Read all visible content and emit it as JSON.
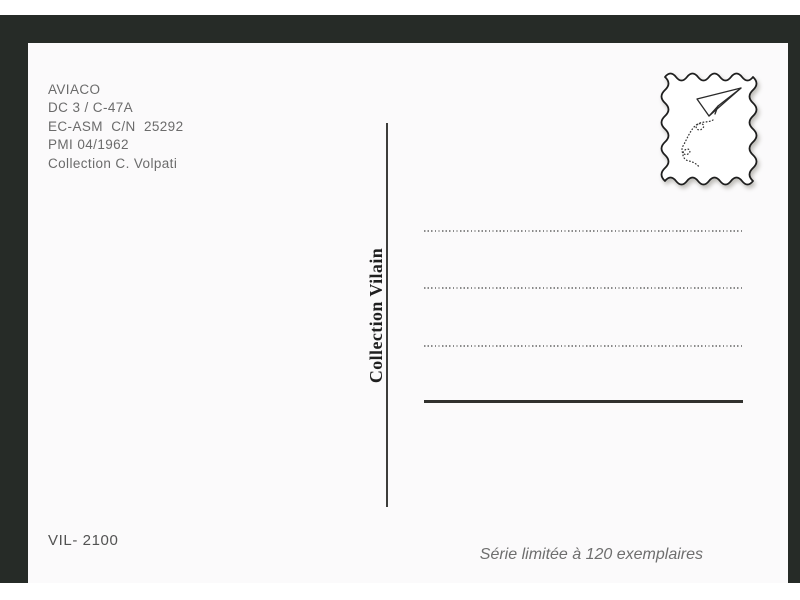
{
  "postcard": {
    "info_lines": [
      "AVIACO",
      "DC 3 / C-47A",
      "EC-ASM  C/N  25292",
      "PMI 04/1962",
      "Collection C. Volpati"
    ],
    "publisher_label": "Collection Vilain",
    "reference_number": "VIL- 2100",
    "edition_note": "Série limitée à 120 exemplaires",
    "stamp_icon": "paper-plane-icon",
    "address_field": {
      "dotted_lines": 3,
      "solid_lines": 1
    }
  },
  "colors": {
    "mat_background": "#262b27",
    "card_background": "#fbfafb",
    "info_text": "#6b6b6b",
    "publisher_text": "#1f1f1f",
    "dotted_line": "#8a8a8a",
    "solid_line": "#31312e"
  }
}
